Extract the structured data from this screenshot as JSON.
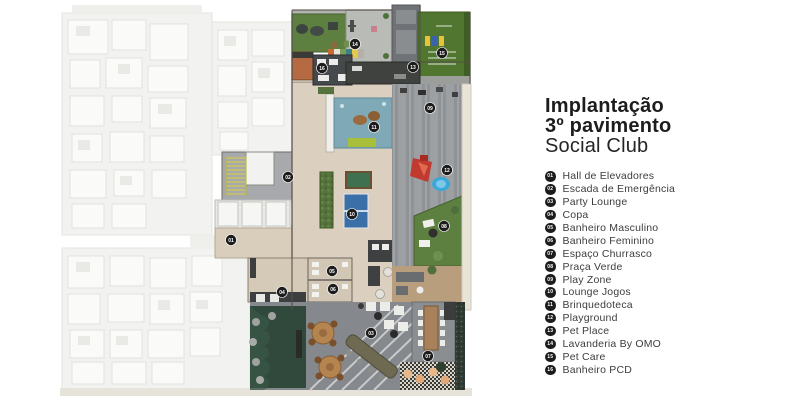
{
  "title": {
    "line1": "Implantação",
    "line2": "3º pavimento",
    "line3": "Social Club"
  },
  "legend": {
    "items": [
      {
        "num": "01",
        "label": "Hall de Elevadores"
      },
      {
        "num": "02",
        "label": "Escada de Emergência"
      },
      {
        "num": "03",
        "label": "Party Lounge"
      },
      {
        "num": "04",
        "label": "Copa"
      },
      {
        "num": "05",
        "label": "Banheiro Masculino"
      },
      {
        "num": "06",
        "label": "Banheiro Feminino"
      },
      {
        "num": "07",
        "label": "Espaço Churrasco"
      },
      {
        "num": "08",
        "label": "Praça Verde"
      },
      {
        "num": "09",
        "label": "Play Zone"
      },
      {
        "num": "10",
        "label": "Lounge Jogos"
      },
      {
        "num": "11",
        "label": "Brinquedoteca"
      },
      {
        "num": "12",
        "label": "Playground"
      },
      {
        "num": "13",
        "label": "Pet Place"
      },
      {
        "num": "14",
        "label": "Lavanderia By OMO"
      },
      {
        "num": "15",
        "label": "Pet Care"
      },
      {
        "num": "16",
        "label": "Banheiro PCD"
      }
    ]
  },
  "plan": {
    "badges": [
      {
        "num": "01",
        "x": 231,
        "y": 240
      },
      {
        "num": "02",
        "x": 288,
        "y": 177
      },
      {
        "num": "03",
        "x": 371,
        "y": 333
      },
      {
        "num": "04",
        "x": 282,
        "y": 292
      },
      {
        "num": "05",
        "x": 332,
        "y": 271
      },
      {
        "num": "06",
        "x": 333,
        "y": 289
      },
      {
        "num": "07",
        "x": 428,
        "y": 356
      },
      {
        "num": "08",
        "x": 444,
        "y": 226
      },
      {
        "num": "09",
        "x": 430,
        "y": 108
      },
      {
        "num": "10",
        "x": 352,
        "y": 214
      },
      {
        "num": "11",
        "x": 374,
        "y": 127
      },
      {
        "num": "12",
        "x": 447,
        "y": 170
      },
      {
        "num": "13",
        "x": 413,
        "y": 67
      },
      {
        "num": "14",
        "x": 355,
        "y": 44
      },
      {
        "num": "15",
        "x": 442,
        "y": 53
      },
      {
        "num": "16",
        "x": 322,
        "y": 68
      }
    ]
  },
  "colors": {
    "badge_bg": "#1c1c1c",
    "badge_text": "#ffffff",
    "lawn_green": "#50762f",
    "garden_dark_green": "#31493d",
    "hedge_green": "#57733d",
    "deck_gray": "#909396",
    "indoor_beige": "#dbcfbf",
    "ballpit_blue": "#7fa9b6",
    "pingpong_blue": "#3a6fa8",
    "pool_table_green": "#3f7050",
    "slide_red": "#c03a30",
    "pool_blue": "#3aa8d8",
    "faded_plan": "#ebece8",
    "wood": "#b5854f"
  }
}
